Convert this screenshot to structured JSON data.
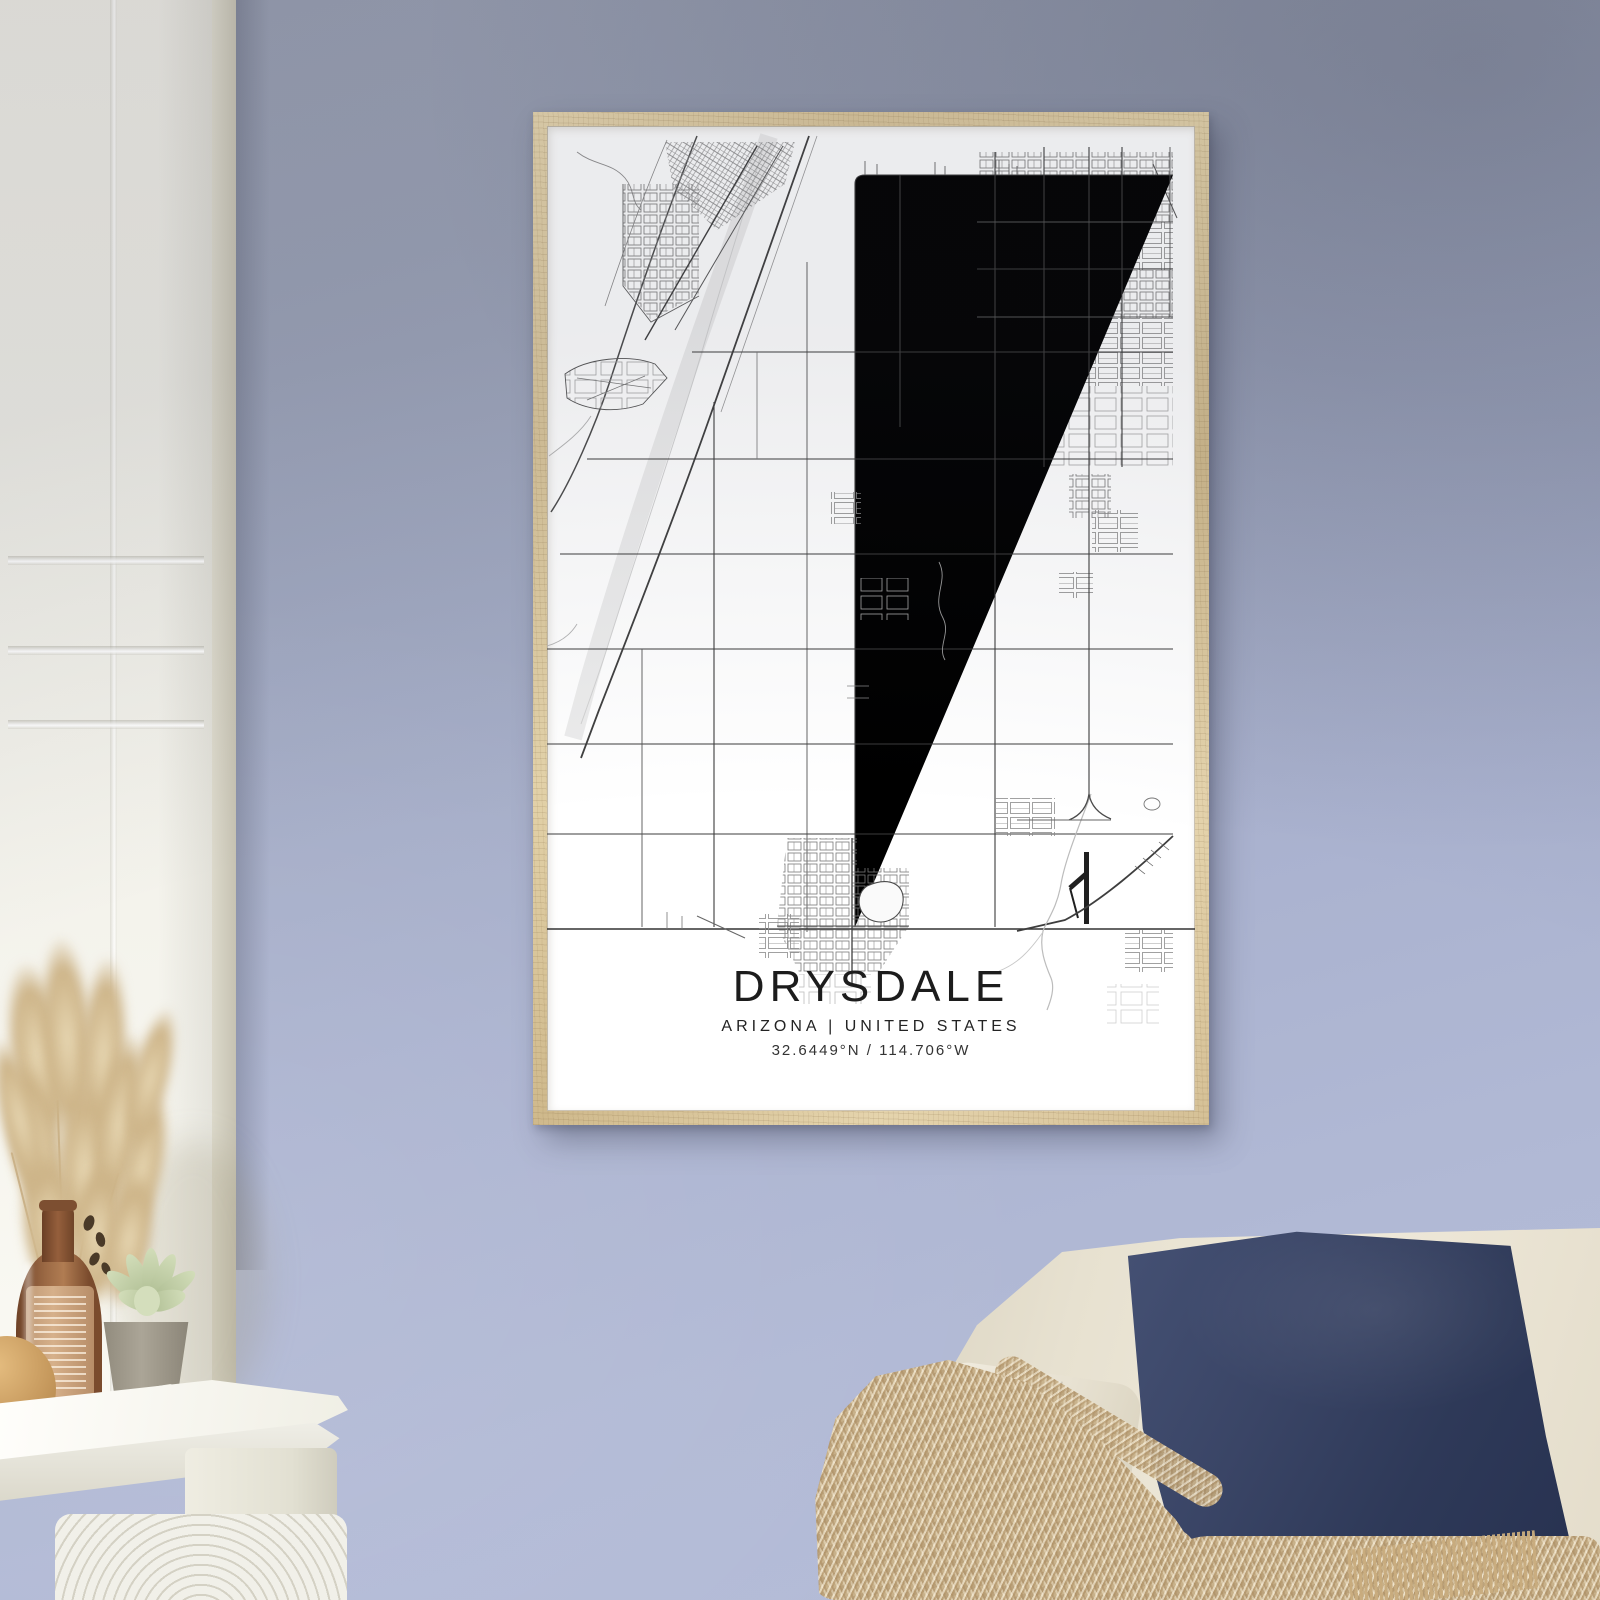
{
  "poster": {
    "title": "DRYSDALE",
    "subtitle": "ARIZONA | UNITED STATES",
    "coordinates": "32.6449°N / 114.706°W"
  },
  "map": {
    "style": "minimalist black-and-white street map",
    "features": [
      "river floodplain northwest",
      "dense city grid northwest",
      "dense suburb grid northeast",
      "rural section-line grid",
      "small town cluster south with pond",
      "airport runway southeast",
      "diagonal highway southeast"
    ]
  },
  "colors": {
    "wall_lavender": "#aab2cf",
    "wall_shadow": "#8e94a5",
    "frame_wood": "#dbc79d",
    "poster_background": "#ffffff",
    "map_road_dark": "#3c3c3c",
    "map_road_light": "#9a9a9a",
    "river_gray": "#ececec",
    "door_white": "#f2f1ea",
    "sofa_cream": "#e9e3d3",
    "pillow_navy": "#2e3958",
    "throw_beige": "#c8b18a",
    "bottle_brown": "#8a5a3c",
    "pampas_beige": "#d5c094"
  }
}
